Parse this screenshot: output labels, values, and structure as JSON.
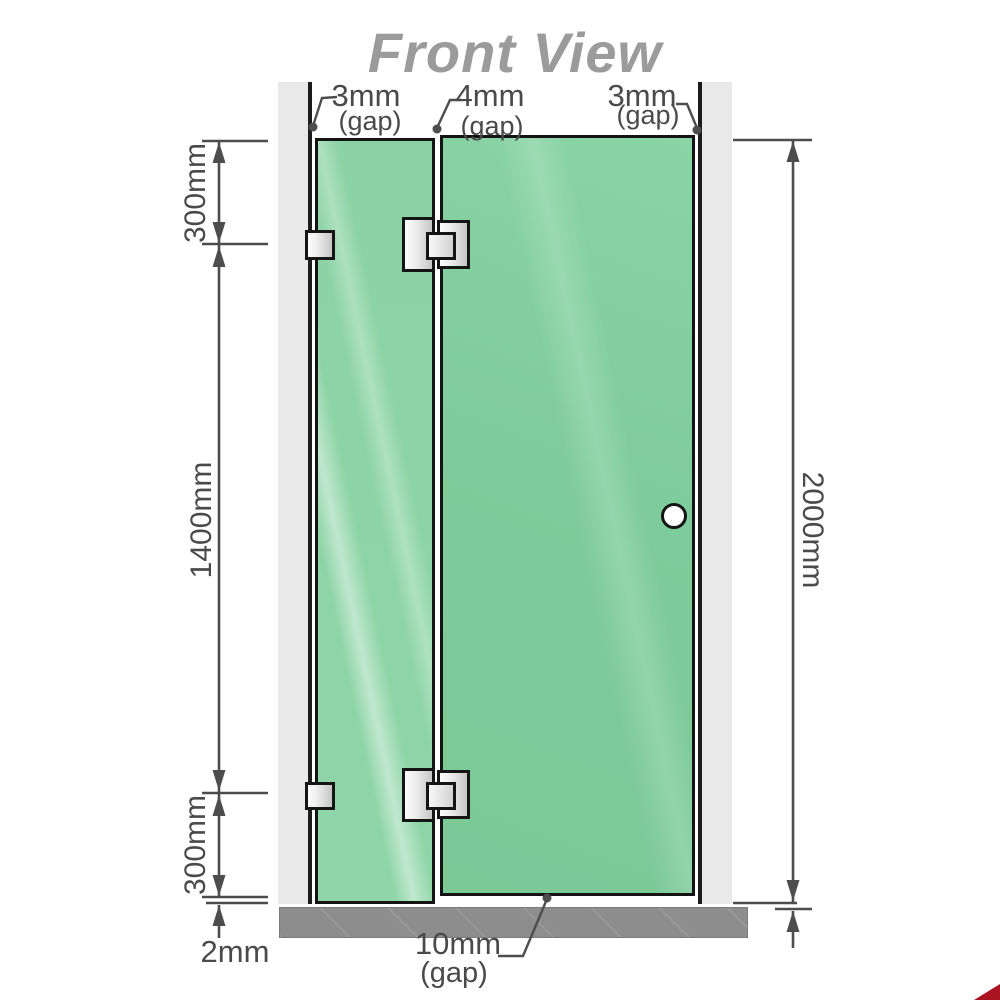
{
  "title": "Front View",
  "top_gap_labels": [
    {
      "value": "3mm",
      "note": "(gap)"
    },
    {
      "value": "4mm",
      "note": "(gap)"
    },
    {
      "value": "3mm",
      "note": "(gap)"
    }
  ],
  "left_dimensions": {
    "top": "300mm",
    "middle": "1400mm",
    "bottom": "300mm"
  },
  "right_dimension": {
    "total": "2000mm"
  },
  "bottom_labels": {
    "floor_gap": "2mm",
    "door_gap_value": "10mm",
    "door_gap_note": "(gap)"
  },
  "colors": {
    "glass_green": "#84cf9f",
    "wall_gray": "#e9e9e9",
    "floor_gray": "#8d8d8d",
    "line_dark": "#4d4d4d",
    "title_gray": "#9b9b9b",
    "corner_red": "#a91420"
  }
}
